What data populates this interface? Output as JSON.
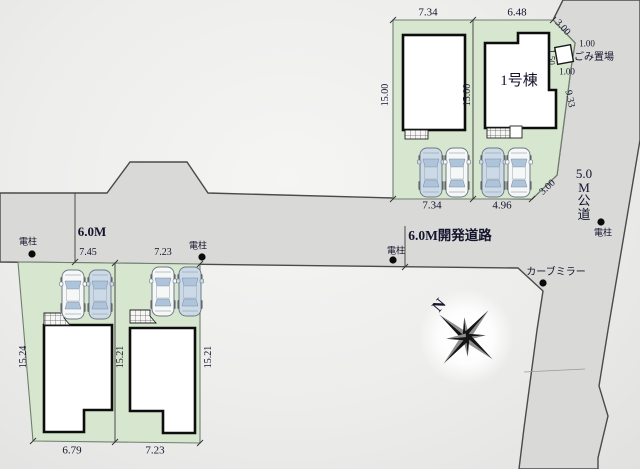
{
  "plan_type": "housing-site-plan",
  "colors": {
    "road_fill": "#d9d9d8",
    "road_stroke": "#4a4a4a",
    "lot_fill": "#d7e6ce",
    "lot_stroke": "#6f7f6f",
    "building_fill": "#ffffff",
    "building_stroke": "#0d0d0d",
    "text": "#14142c",
    "car_white": "#f6f8f8",
    "car_blue": "#ccd9e7",
    "car_glass": "#aec4da",
    "pole_dot": "#0a0a0a"
  },
  "labels": [
    {
      "name": "dim-north-lot2-top",
      "text": "7.34",
      "x": 428,
      "y": 13,
      "rot": 0,
      "size": 11
    },
    {
      "name": "dim-north-lot1-top",
      "text": "6.48",
      "x": 517,
      "y": 13,
      "rot": 0,
      "size": 11
    },
    {
      "name": "dim-corner-cut-top",
      "text": "3.00",
      "x": 562,
      "y": 28,
      "rot": 47,
      "size": 10
    },
    {
      "name": "dim-trash-top",
      "text": "1.00",
      "x": 587,
      "y": 44,
      "rot": 0,
      "size": 9
    },
    {
      "name": "dim-trash-side",
      "text": "1.50",
      "x": 551,
      "y": 57,
      "rot": 90,
      "size": 9
    },
    {
      "name": "trash-area-label",
      "text": "ごみ置場",
      "x": 594,
      "y": 58,
      "rot": 0,
      "size": 10
    },
    {
      "name": "dim-trash-bottom",
      "text": "1.00",
      "x": 567,
      "y": 72,
      "rot": 0,
      "size": 9
    },
    {
      "name": "building-1-name",
      "text": "1号棟",
      "x": 519,
      "y": 82,
      "rot": 0,
      "size": 15
    },
    {
      "name": "dim-north-lot2-left",
      "text": "15.00",
      "x": 386,
      "y": 95,
      "rot": -90,
      "size": 10
    },
    {
      "name": "dim-north-boundary",
      "text": "15.00",
      "x": 468,
      "y": 95,
      "rot": -90,
      "size": 10
    },
    {
      "name": "dim-east-edge",
      "text": "9.33",
      "x": 569,
      "y": 99,
      "rot": 78,
      "size": 10
    },
    {
      "name": "dim-north-lot2-bottom",
      "text": "7.34",
      "x": 432,
      "y": 206,
      "rot": 0,
      "size": 11
    },
    {
      "name": "dim-north-lot1-bottom",
      "text": "4.96",
      "x": 502,
      "y": 206,
      "rot": 0,
      "size": 11
    },
    {
      "name": "dim-corner-cut-bottom",
      "text": "3.00",
      "x": 548,
      "y": 188,
      "rot": -43,
      "size": 10
    },
    {
      "name": "public-road-name",
      "text": "5.0\nM\n公\n道",
      "x": 584,
      "y": 194,
      "rot": 0,
      "size": 13
    },
    {
      "name": "pole-label-east",
      "text": "電柱",
      "x": 603,
      "y": 233,
      "rot": 0,
      "size": 9
    },
    {
      "name": "development-road-name",
      "text": "6.0M開発道路",
      "x": 450,
      "y": 236,
      "rot": 0,
      "size": 13.5,
      "bold": true
    },
    {
      "name": "pole-label-mid",
      "text": "電柱",
      "x": 396,
      "y": 251,
      "rot": 0,
      "size": 9
    },
    {
      "name": "road-width-label",
      "text": "6.0M",
      "x": 92,
      "y": 232,
      "rot": 0,
      "size": 13,
      "bold": true
    },
    {
      "name": "pole-label-west",
      "text": "電柱",
      "x": 28,
      "y": 242,
      "rot": 0,
      "size": 9
    },
    {
      "name": "dim-south-lotA-top",
      "text": "7.45",
      "x": 88,
      "y": 253,
      "rot": 0,
      "size": 10
    },
    {
      "name": "dim-south-lotB-top",
      "text": "7.23",
      "x": 163,
      "y": 253,
      "rot": 0,
      "size": 10
    },
    {
      "name": "pole-label-lotB",
      "text": "電柱",
      "x": 198,
      "y": 246,
      "rot": 0,
      "size": 9
    },
    {
      "name": "curve-mirror-label",
      "text": "カーブミラー",
      "x": 556,
      "y": 273,
      "rot": 0,
      "size": 10
    },
    {
      "name": "dim-south-lotA-left",
      "text": "15.24",
      "x": 24,
      "y": 357,
      "rot": -90,
      "size": 10
    },
    {
      "name": "dim-south-boundary",
      "text": "15.21",
      "x": 121,
      "y": 357,
      "rot": -90,
      "size": 10
    },
    {
      "name": "dim-south-lotB-right",
      "text": "15.21",
      "x": 209,
      "y": 357,
      "rot": -90,
      "size": 10
    },
    {
      "name": "dim-south-lotA-bottom",
      "text": "6.79",
      "x": 72,
      "y": 451,
      "rot": 0,
      "size": 11
    },
    {
      "name": "dim-south-lotB-bottom",
      "text": "7.23",
      "x": 155,
      "y": 451,
      "rot": 0,
      "size": 11
    },
    {
      "name": "compass-north-label",
      "text": "N",
      "x": 440,
      "y": 306,
      "rot": -50,
      "size": 16,
      "bold": true
    }
  ],
  "utility_poles": [
    {
      "name": "pole-west",
      "x": 32,
      "y": 254
    },
    {
      "name": "pole-lotB",
      "x": 202,
      "y": 257
    },
    {
      "name": "pole-mid",
      "x": 393,
      "y": 260
    },
    {
      "name": "pole-east",
      "x": 601,
      "y": 222
    },
    {
      "name": "curve-mirror",
      "x": 543,
      "y": 283
    }
  ],
  "cars": [
    {
      "lot": "north-lot2",
      "x": 420,
      "y": 148,
      "color": "blue"
    },
    {
      "lot": "north-lot2",
      "x": 446,
      "y": 148,
      "color": "white"
    },
    {
      "lot": "north-lot1",
      "x": 482,
      "y": 148,
      "color": "blue"
    },
    {
      "lot": "north-lot1",
      "x": 508,
      "y": 148,
      "color": "white"
    },
    {
      "lot": "south-lotA",
      "x": 62,
      "y": 270,
      "color": "white"
    },
    {
      "lot": "south-lotA",
      "x": 89,
      "y": 270,
      "color": "blue"
    },
    {
      "lot": "south-lotB",
      "x": 152,
      "y": 267,
      "color": "white"
    },
    {
      "lot": "south-lotB",
      "x": 179,
      "y": 267,
      "color": "blue"
    }
  ]
}
